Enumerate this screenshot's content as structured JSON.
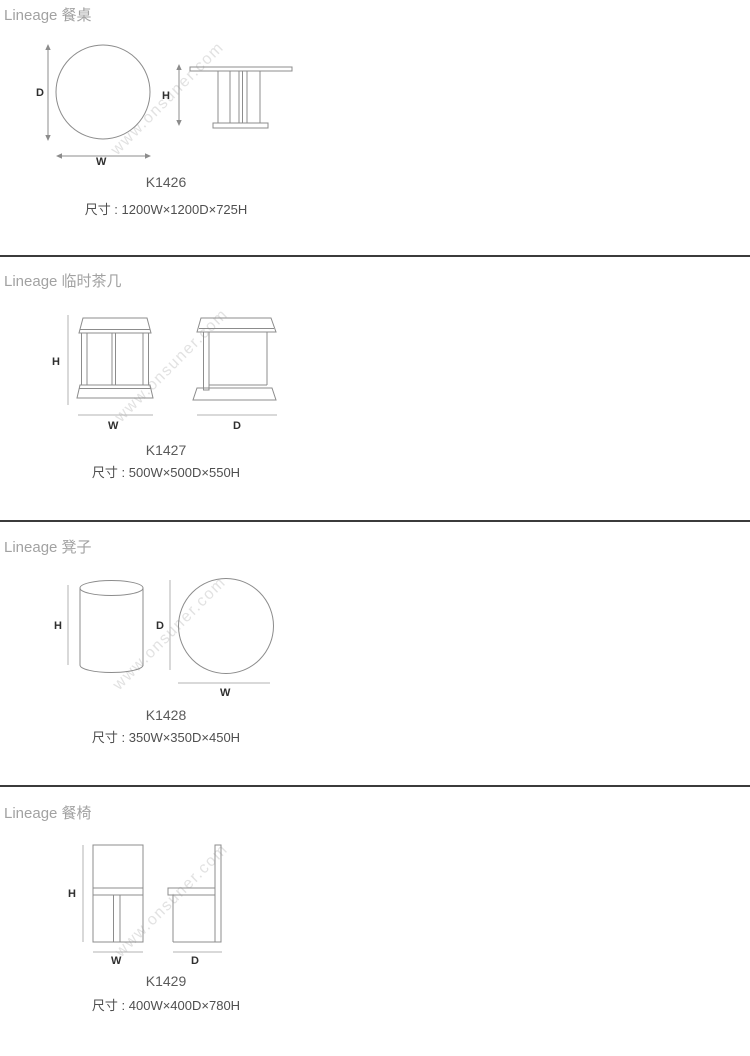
{
  "page": {
    "background": "#ffffff",
    "divider_color": "#3b3b3b",
    "drawing_line_color": "#8c8c8c",
    "dimension_line_color": "#b3b3b3",
    "header_color": "#a2a2a2",
    "model_color": "#5a5a5a",
    "size_color": "#4f4f4f",
    "dim_label_color": "#2f2f2f"
  },
  "watermark": {
    "text": "www.onsuner.com",
    "color": "#e2e2e2"
  },
  "dim_labels": {
    "width": "W",
    "depth": "D",
    "height": "H"
  },
  "sections": [
    {
      "header": "Lineage 餐桌",
      "model": "K1426",
      "size": "尺寸 : 1200W×1200D×725H"
    },
    {
      "header": "Lineage 临时茶几",
      "model": "K1427",
      "size": "尺寸 : 500W×500D×550H"
    },
    {
      "header": "Lineage 凳子",
      "model": "K1428",
      "size": "尺寸 : 350W×350D×450H"
    },
    {
      "header": "Lineage 餐椅",
      "model": "K1429",
      "size": "尺寸 : 400W×400D×780H"
    }
  ]
}
